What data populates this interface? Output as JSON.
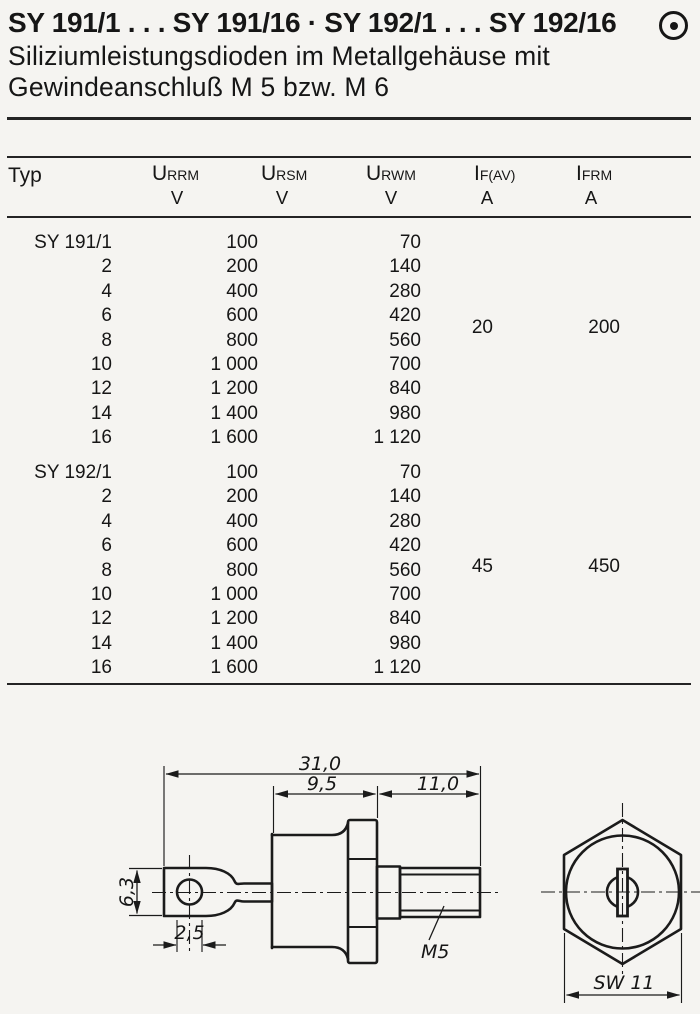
{
  "header": {
    "title": "SY 191/1 . . . SY 191/16 · SY 192/1 . . . SY 192/16",
    "subtitle_line1": "Siliziumleistungsdioden im Metallgehäuse mit",
    "subtitle_line2": "Gewindeanschluß M 5 bzw. M 6",
    "corner_symbol": "circled-dot",
    "ink_color": "#161616",
    "paper_color": "#f5f4f1"
  },
  "table": {
    "headers": {
      "typ": "Typ",
      "urrm": {
        "base": "U",
        "sub": "RRM",
        "unit": "V"
      },
      "ursm": {
        "base": "U",
        "sub": "RSM",
        "unit": "V"
      },
      "urwm": {
        "base": "U",
        "sub": "RWM",
        "unit": "V"
      },
      "ifav": {
        "base": "I",
        "sub": "F(AV)",
        "unit": "A"
      },
      "ifrm": {
        "base": "I",
        "sub": "FRM",
        "unit": "A"
      }
    },
    "groups": [
      {
        "ifav": "20",
        "ifrm": "200",
        "rows": [
          {
            "typ": "SY 191/1",
            "urrm": "100",
            "urwm": "70"
          },
          {
            "typ": "2",
            "urrm": "200",
            "urwm": "140"
          },
          {
            "typ": "4",
            "urrm": "400",
            "urwm": "280"
          },
          {
            "typ": "6",
            "urrm": "600",
            "urwm": "420"
          },
          {
            "typ": "8",
            "urrm": "800",
            "urwm": "560"
          },
          {
            "typ": "10",
            "urrm": "1 000",
            "urwm": "700"
          },
          {
            "typ": "12",
            "urrm": "1 200",
            "urwm": "840"
          },
          {
            "typ": "14",
            "urrm": "1 400",
            "urwm": "980"
          },
          {
            "typ": "16",
            "urrm": "1 600",
            "urwm": "1 120"
          }
        ]
      },
      {
        "ifav": "45",
        "ifrm": "450",
        "rows": [
          {
            "typ": "SY 192/1",
            "urrm": "100",
            "urwm": "70"
          },
          {
            "typ": "2",
            "urrm": "200",
            "urwm": "140"
          },
          {
            "typ": "4",
            "urrm": "400",
            "urwm": "280"
          },
          {
            "typ": "6",
            "urrm": "600",
            "urwm": "420"
          },
          {
            "typ": "8",
            "urrm": "800",
            "urwm": "560"
          },
          {
            "typ": "10",
            "urrm": "1 000",
            "urwm": "700"
          },
          {
            "typ": "12",
            "urrm": "1 200",
            "urwm": "840"
          },
          {
            "typ": "14",
            "urrm": "1 400",
            "urwm": "980"
          },
          {
            "typ": "16",
            "urrm": "1 600",
            "urwm": "1 120"
          }
        ]
      }
    ]
  },
  "drawing": {
    "side_view": {
      "overall_length": "31,0",
      "case_length": "9,5",
      "stud_length": "11,0",
      "tab_width": "6,3",
      "hole_dia": "2,5",
      "thread": "M5"
    },
    "end_view": {
      "wrench_size": "SW 11"
    }
  }
}
